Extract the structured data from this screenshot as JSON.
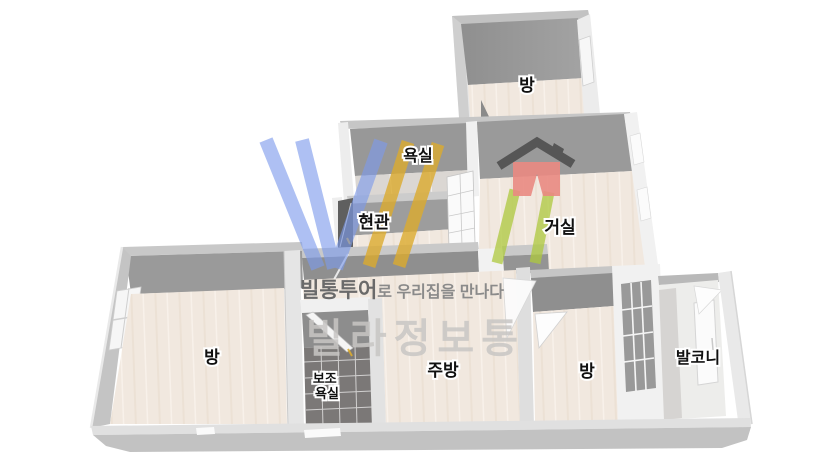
{
  "image": {
    "type": "3d-floorplan-render",
    "description": "Isometric 3D floor plan of a villa unit with Korean room labels and a watermark logo"
  },
  "colors": {
    "background": "#ffffff",
    "wall_top": "#c6c6c6",
    "wall_inner_dark": "#9a9a9a",
    "wall_outer_light": "#ececec",
    "floor_beige": "#f1e8df",
    "tile_dark": "#7b7877",
    "balcony_floor": "#d6d4d2",
    "logo_blue": "#7d9bec",
    "logo_gold": "#dcab2e",
    "logo_green": "#aec93e",
    "house_red": "#ea8a82",
    "roof_gray": "#4f4f4f",
    "label_text": "#111111"
  },
  "rooms": [
    {
      "id": "bedroom-top",
      "label": "방"
    },
    {
      "id": "bathroom",
      "label": "욕실"
    },
    {
      "id": "entrance",
      "label": "현관"
    },
    {
      "id": "living-room",
      "label": "거실"
    },
    {
      "id": "bedroom-left",
      "label": "방"
    },
    {
      "id": "aux-bathroom",
      "label_line1": "보조",
      "label_line2": "욕실"
    },
    {
      "id": "kitchen",
      "label": "주방"
    },
    {
      "id": "bedroom-right",
      "label": "방"
    },
    {
      "id": "balcony",
      "label": "발코니"
    }
  ],
  "watermark": {
    "logo_letters": "VILL",
    "line1_bold": "빌통투어",
    "line1_rest": "로 우리집을 만나다",
    "line2": "빌라정보통"
  }
}
